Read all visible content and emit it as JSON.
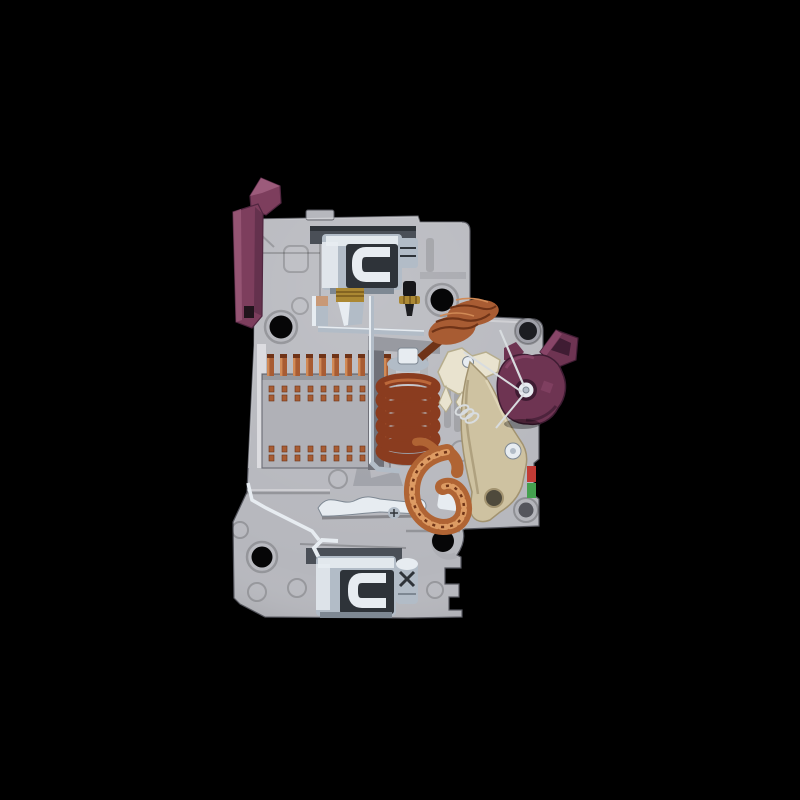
{
  "scene": {
    "type": "photograph",
    "subject": "Miniature circuit breaker (MCB) with side cover removed, exposing the internal trip mechanism",
    "view": "side profile, toggle lever at upper left, DIN-rail foot at bottom",
    "background": "black"
  },
  "colors": {
    "background": "#000000",
    "body": "#b6b7bd",
    "body_light": "#d8d9dd",
    "body_shadow": "#989aa1",
    "body_dark": "#707179",
    "body_edge": "#54555d",
    "metal_bright": "#e7ecf1",
    "metal_mid": "#b2bcc7",
    "metal_shadow": "#7e8893",
    "metal_dark": "#2e3339",
    "steel": "#4a4f57",
    "brass": "#ab8833",
    "brass_dark": "#77591c",
    "copper": "#a85c33",
    "copper_light": "#d18a56",
    "copper_dark": "#6f3317",
    "coil": "#8a3c1f",
    "coil_hi": "#c4703f",
    "braid": "#b06434",
    "braid_hi": "#dd9b63",
    "toggle": "#7d3e5d",
    "toggle_light": "#a05e7e",
    "toggle_dark": "#512640",
    "cam": "#6e3452",
    "cam_light": "#8f4a6e",
    "cam_dark": "#3f1c33",
    "beige": "#cec2a1",
    "beige_dark": "#a29370",
    "cream": "#e9e3cf",
    "cream_dark": "#b6ad8d",
    "indicator_red": "#c23b35",
    "indicator_green": "#44a04f",
    "hole": "#060607"
  },
  "components": [
    {
      "name": "toggle-lever",
      "desc": "plum plastic switch dolly, upper left",
      "color_key": "toggle"
    },
    {
      "name": "housing",
      "desc": "light gray molded case with DIN-rail foot and round mounting holes",
      "color_key": "body"
    },
    {
      "name": "top-terminal",
      "desc": "zinc-plated box clamp screw terminal, top",
      "color_key": "metal_bright"
    },
    {
      "name": "bottom-terminal",
      "desc": "zinc-plated box clamp screw terminal with cross screw, bottom",
      "color_key": "metal_bright"
    },
    {
      "name": "arc-chute",
      "desc": "arc splitter plate stack with copper teeth and rivet rows",
      "color_key": "copper"
    },
    {
      "name": "solenoid-coil",
      "desc": "magnetic trip coil wound on plunger core",
      "color_key": "coil"
    },
    {
      "name": "coil-lead-wraps",
      "desc": "loose copper winding leads above the coil",
      "color_key": "copper"
    },
    {
      "name": "trip-rod",
      "desc": "thin steel connecting rod and link bar",
      "color_key": "metal_mid"
    },
    {
      "name": "contact-arm",
      "desc": "bright moving contact arm, bottom center",
      "color_key": "metal_bright"
    },
    {
      "name": "braided-strap",
      "desc": "flexible braided copper conductor loop",
      "color_key": "braid"
    },
    {
      "name": "actuator-link",
      "desc": "ivory actuator link with rivet",
      "color_key": "cream"
    },
    {
      "name": "latch-lever",
      "desc": "beige trip latch lever with pivot rivet and hole",
      "color_key": "beige"
    },
    {
      "name": "rotary-cam",
      "desc": "plum rotary cam with square drive opening",
      "color_key": "cam"
    },
    {
      "name": "indicator-stripes",
      "desc": "red and green state indicator slivers at latch edge",
      "color_key": "indicator_red"
    },
    {
      "name": "terminal-screws",
      "desc": "brass and black steel adjustment screws",
      "color_key": "brass"
    }
  ],
  "counts": {
    "arc_plates": 10,
    "rivet_pairs_per_row": 9,
    "rivet_rows": 2,
    "coil_turns": 6,
    "mounting_holes": 4
  }
}
